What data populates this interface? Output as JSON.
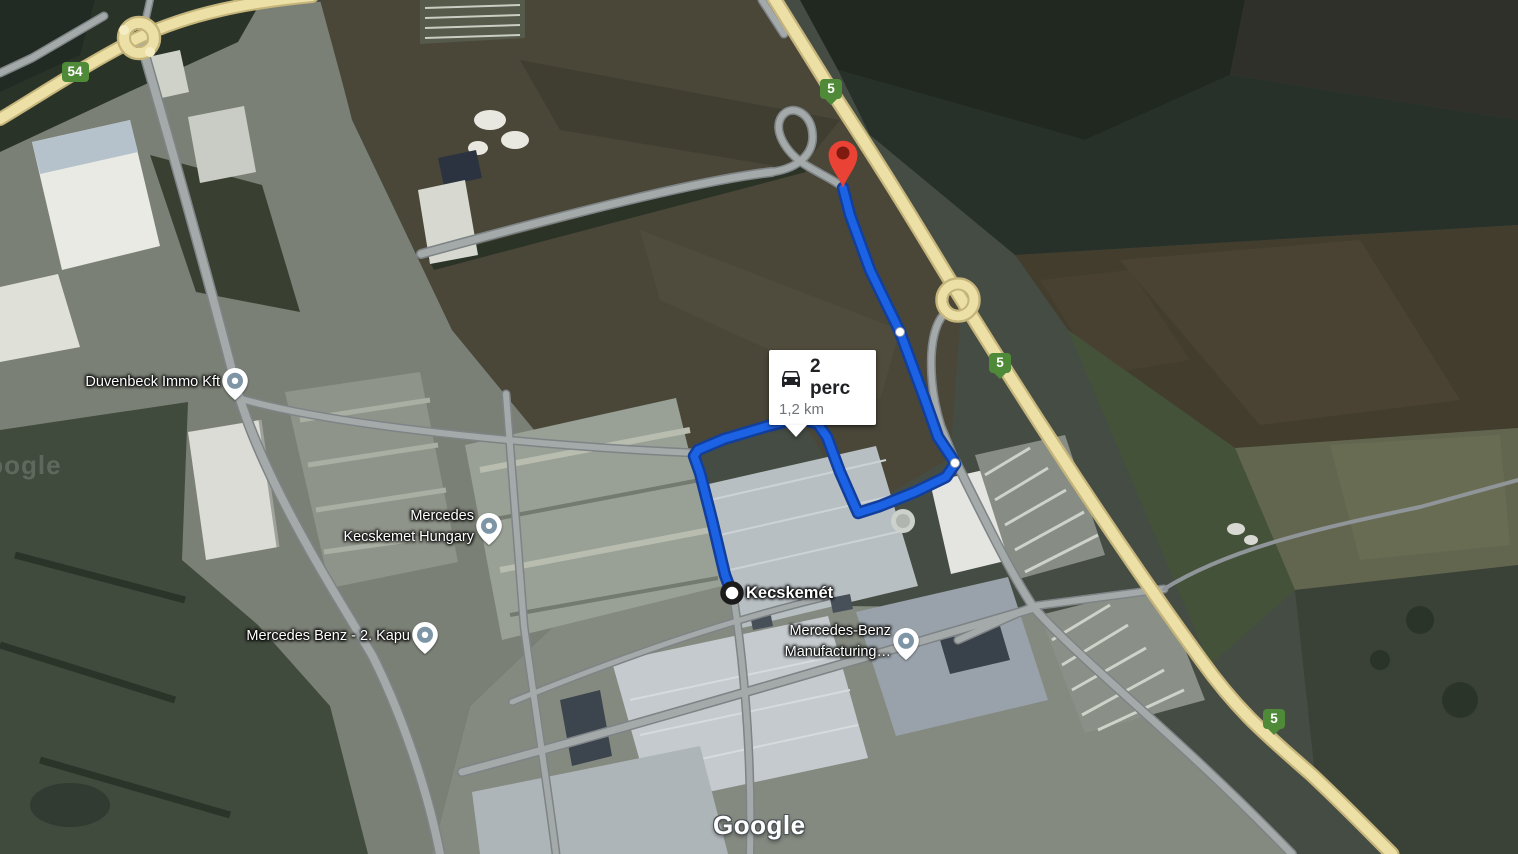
{
  "map": {
    "attribution_logo": "Google",
    "watermark_partial": "Google",
    "route": {
      "duration_label": "2 perc",
      "distance_label": "1,2 km",
      "origin_label": "Kecskemét",
      "colors": {
        "line": "#1c62e5",
        "casing": "#123f9b",
        "pin": "#ea4335",
        "pin_inner": "#7f1a11"
      },
      "points": [
        [
          843,
          188
        ],
        [
          850,
          215
        ],
        [
          870,
          270
        ],
        [
          900,
          332
        ],
        [
          925,
          400
        ],
        [
          938,
          437
        ],
        [
          952,
          458
        ],
        [
          955,
          464
        ],
        [
          946,
          477
        ],
        [
          915,
          492
        ],
        [
          880,
          506
        ],
        [
          858,
          513
        ],
        [
          840,
          472
        ],
        [
          827,
          437
        ],
        [
          818,
          424
        ],
        [
          800,
          418
        ],
        [
          768,
          426
        ],
        [
          724,
          439
        ],
        [
          698,
          450
        ],
        [
          694,
          456
        ],
        [
          700,
          473
        ],
        [
          712,
          520
        ],
        [
          725,
          575
        ],
        [
          731,
          591
        ]
      ],
      "via_points": [
        [
          900,
          332
        ],
        [
          955,
          463
        ],
        [
          800,
          418
        ]
      ],
      "origin_point": [
        732,
        593
      ],
      "destination_point": [
        843,
        152
      ]
    },
    "poi_markers": [
      {
        "id": "duvenbeck-immo-kft",
        "lines": [
          "Duvenbeck Immo Kft"
        ],
        "x": 235,
        "y": 382
      },
      {
        "id": "mercedes-kecskemet-hungary",
        "lines": [
          "Mercedes",
          "Kecskemet Hungary"
        ],
        "x": 489,
        "y": 527
      },
      {
        "id": "mercedes-benz-2-kapu",
        "lines": [
          "Mercedes Benz - 2. Kapu"
        ],
        "x": 425,
        "y": 636
      },
      {
        "id": "mercedes-benz-manufacturing",
        "lines": [
          "Mercedes-Benz",
          "Manufacturing…"
        ],
        "x": 906,
        "y": 642
      }
    ],
    "poi_marker_color": "#7e95a5",
    "road_shields": [
      {
        "number": "54",
        "x": 75,
        "y": 72,
        "pointed": false
      },
      {
        "number": "5",
        "x": 831,
        "y": 92,
        "pointed": true
      },
      {
        "number": "5",
        "x": 1000,
        "y": 366,
        "pointed": true
      },
      {
        "number": "5",
        "x": 1274,
        "y": 722,
        "pointed": true
      }
    ],
    "shield_color": "#4f8a38",
    "road_colors": {
      "highway_fill": "#ece0a6",
      "highway_casing": "#c6b57b",
      "street_fill": "#a4a9aa",
      "street_casing": "#7e8486"
    }
  }
}
